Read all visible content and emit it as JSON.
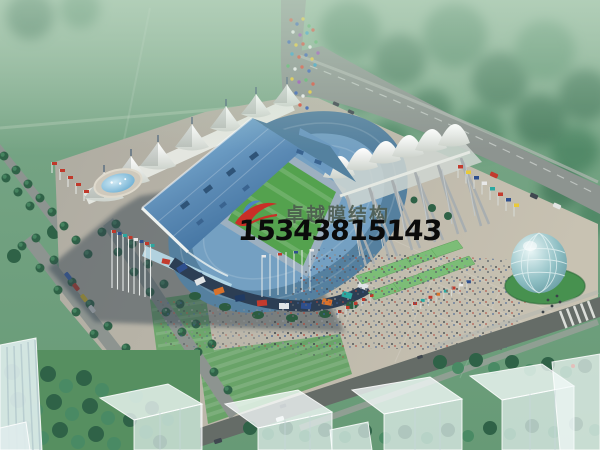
{
  "watermark": {
    "company_name": "卓越膜结构",
    "phone_number": "15343815143",
    "logo_icon": "red-blue-swoosh"
  },
  "palette": {
    "haze_green": "#7ca78a",
    "lawn_green": "#6f9f7d",
    "tree_green": "#2f6247",
    "tree_green_light": "#498a64",
    "road_grey": "#8d9490",
    "road_dark": "#656c67",
    "plaza_beige": "#c2bdb0",
    "plaza_grey": "#aeaba1",
    "roof_blue": "#4f7fa9",
    "roof_blue_light": "#8cc0e2",
    "canopy_white": "#f3f4ef",
    "pitch_green": "#54a24e",
    "track_blue": "#9db0c0",
    "water_blue": "#5aa4cf",
    "dome_teal": "#8fbfc4",
    "shadow_blue": "#33424f",
    "ghost_white": "#ecf6f6",
    "flag_red": "#c0392b",
    "flag_blue": "#2e4f8e",
    "flag_teal": "#2ba8a0",
    "flag_yellow": "#e0c23a",
    "logo_red": "#c92f27",
    "logo_blue": "#4a7fd0",
    "company_text_grey": "#4b5a4e",
    "phone_text_black": "#0b0b0b"
  }
}
